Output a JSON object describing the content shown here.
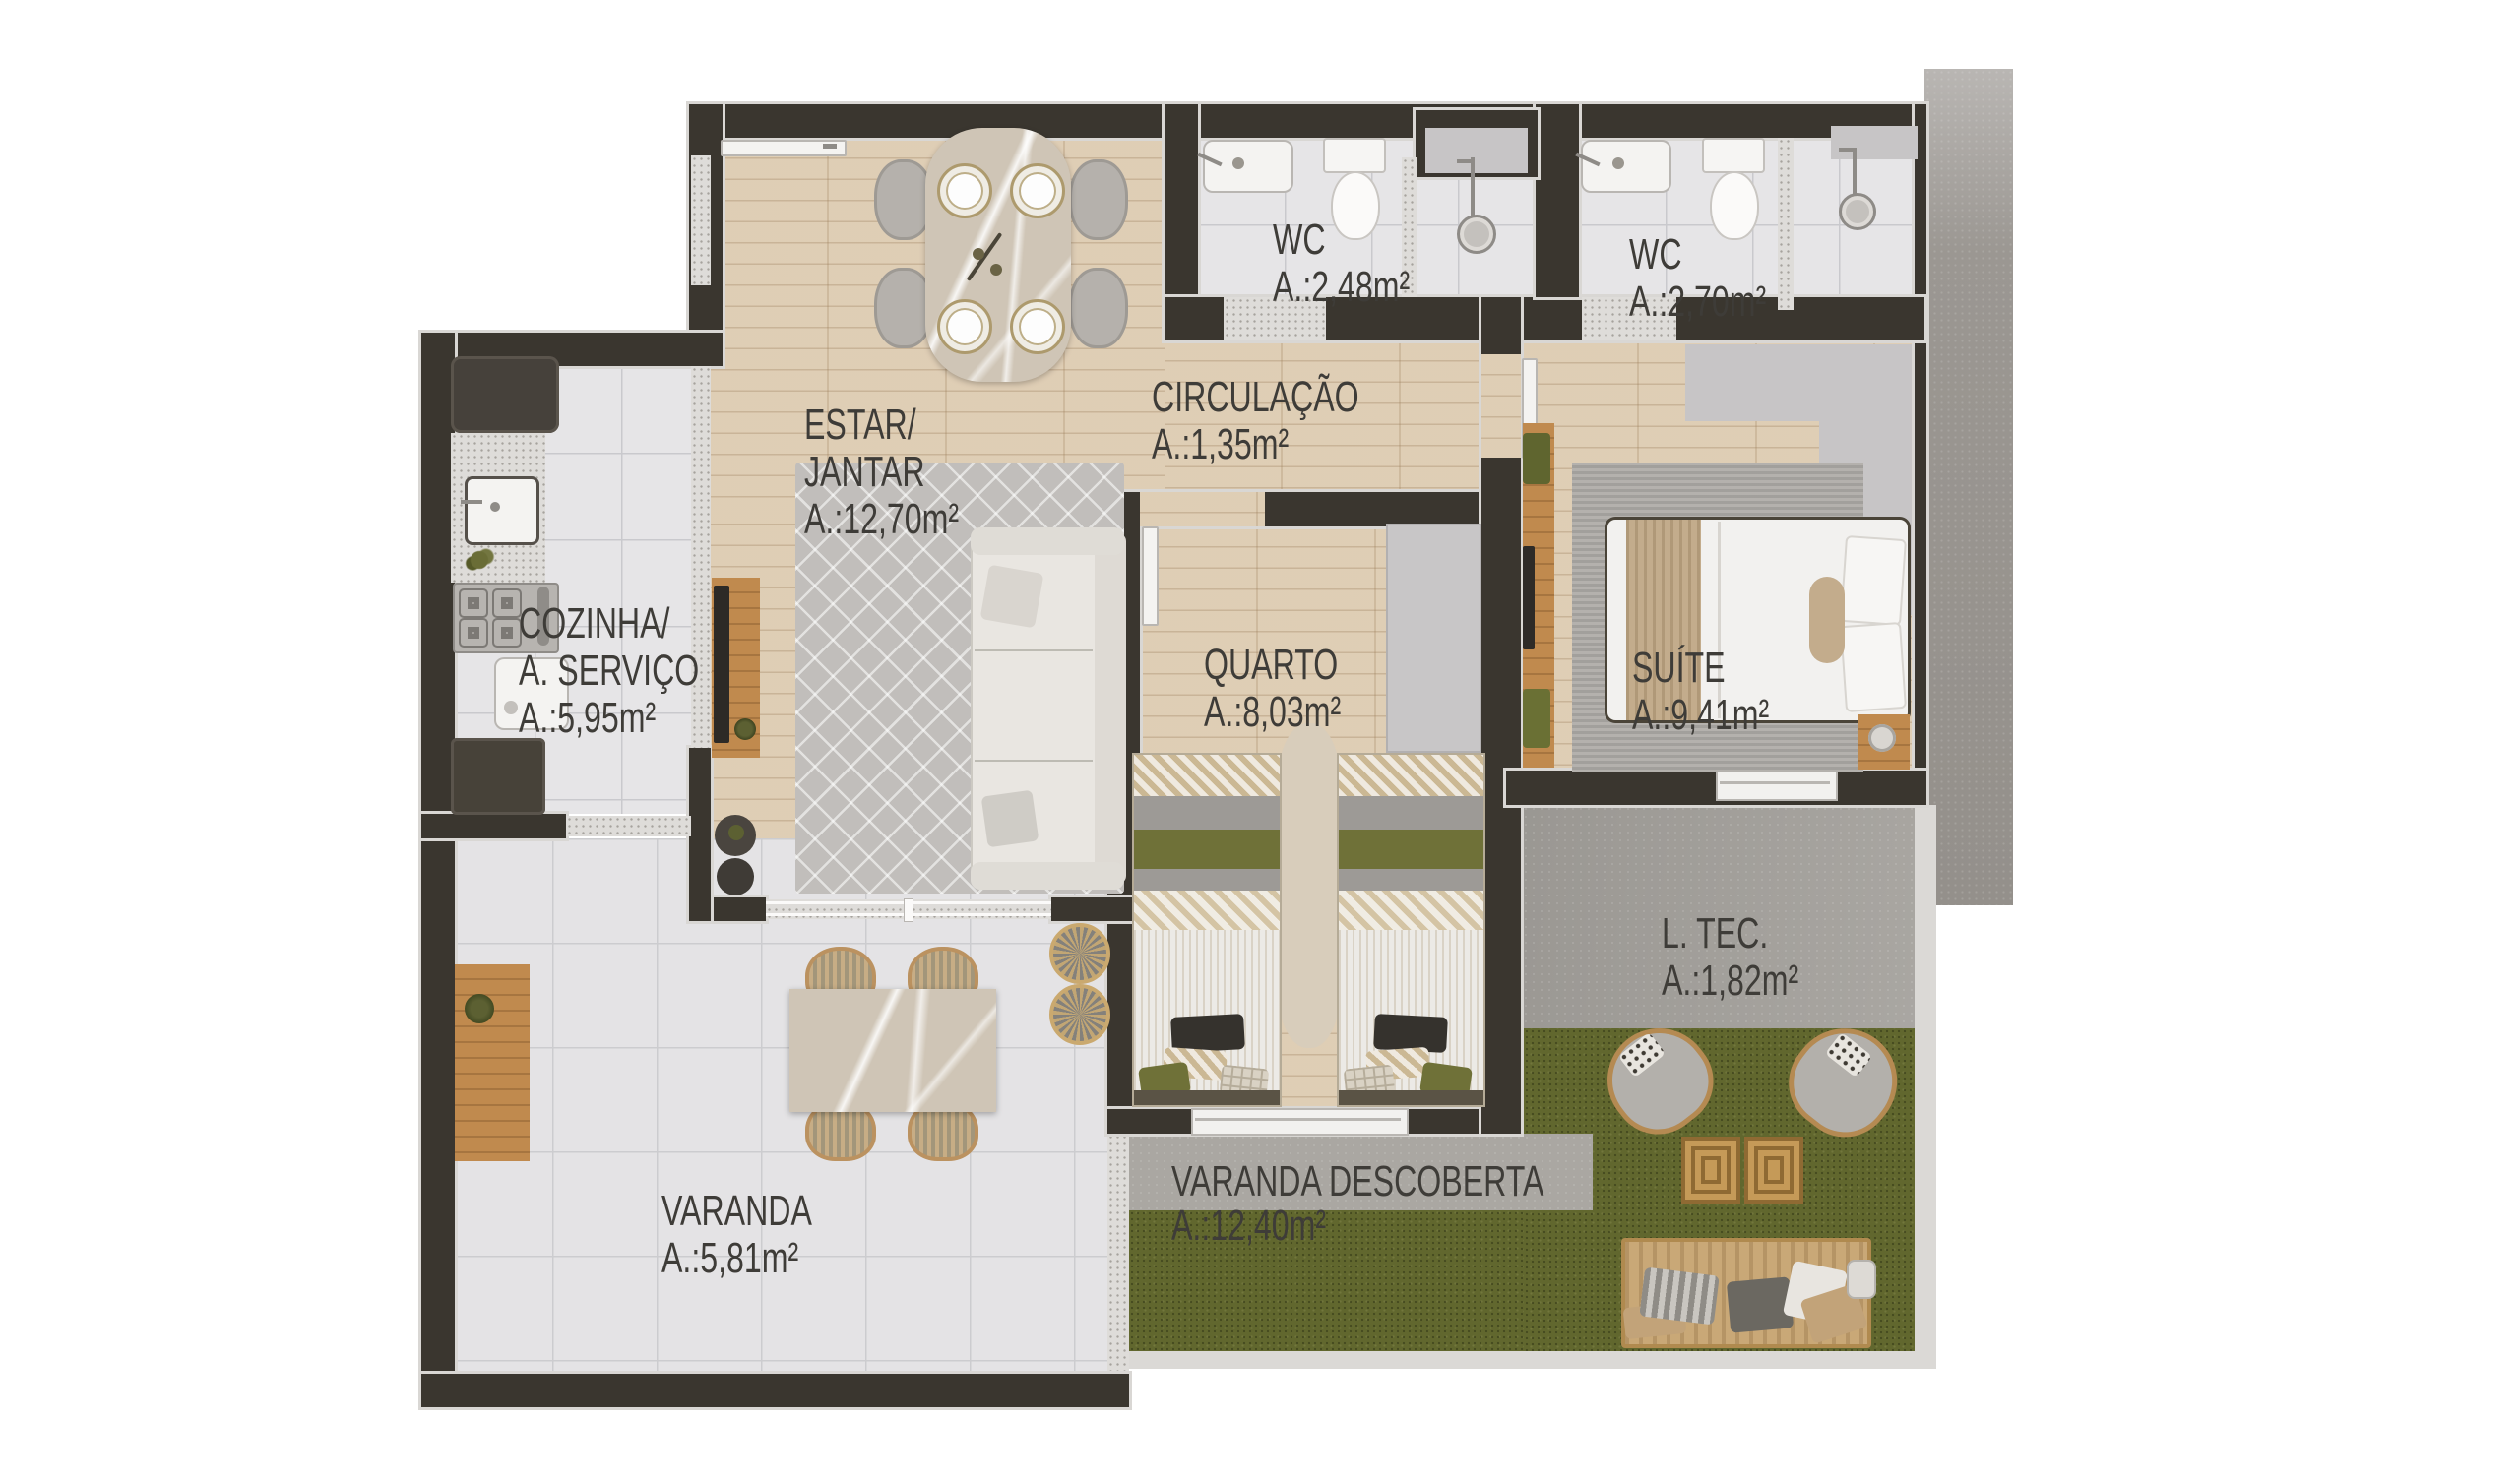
{
  "plan_type": "apartment-floor-plan",
  "rooms": {
    "estar_jantar": {
      "name": "ESTAR/\nJANTAR",
      "area": "A.:12,70m²"
    },
    "cozinha": {
      "name": "COZINHA/\nA. SERVIÇO",
      "area": "A.:5,95m²"
    },
    "wc1": {
      "name": "WC",
      "area": "A.:2,48m²"
    },
    "wc2": {
      "name": "WC",
      "area": "A.:2,70m²"
    },
    "circulacao": {
      "name": "CIRCULAÇÃO",
      "area": "A.:1,35m²"
    },
    "quarto": {
      "name": "QUARTO",
      "area": "A.:8,03m²"
    },
    "suite": {
      "name": "SUÍTE",
      "area": "A.:9,41m²"
    },
    "ltec": {
      "name": "L. TEC.",
      "area": "A.:1,82m²"
    },
    "varanda": {
      "name": "VARANDA",
      "area": "A.:5,81m²"
    },
    "varanda_descoberta": {
      "name": "VARANDA DESCOBERTA",
      "area": "A.:12,40m²"
    }
  },
  "palette": {
    "wall": "#3a362f",
    "wall_trim": "#d9d7d4",
    "wood_floor": "#dbc8ad",
    "tile_floor": "#e6e5e7",
    "grass": "#61672e",
    "concrete": "#a3a09b",
    "granite_speckle": "#dedcd9",
    "label_text": "#3e3c38",
    "furniture_wood": "#c08a4e",
    "olive_textile": "#6f7138",
    "background": "#ffffff"
  }
}
